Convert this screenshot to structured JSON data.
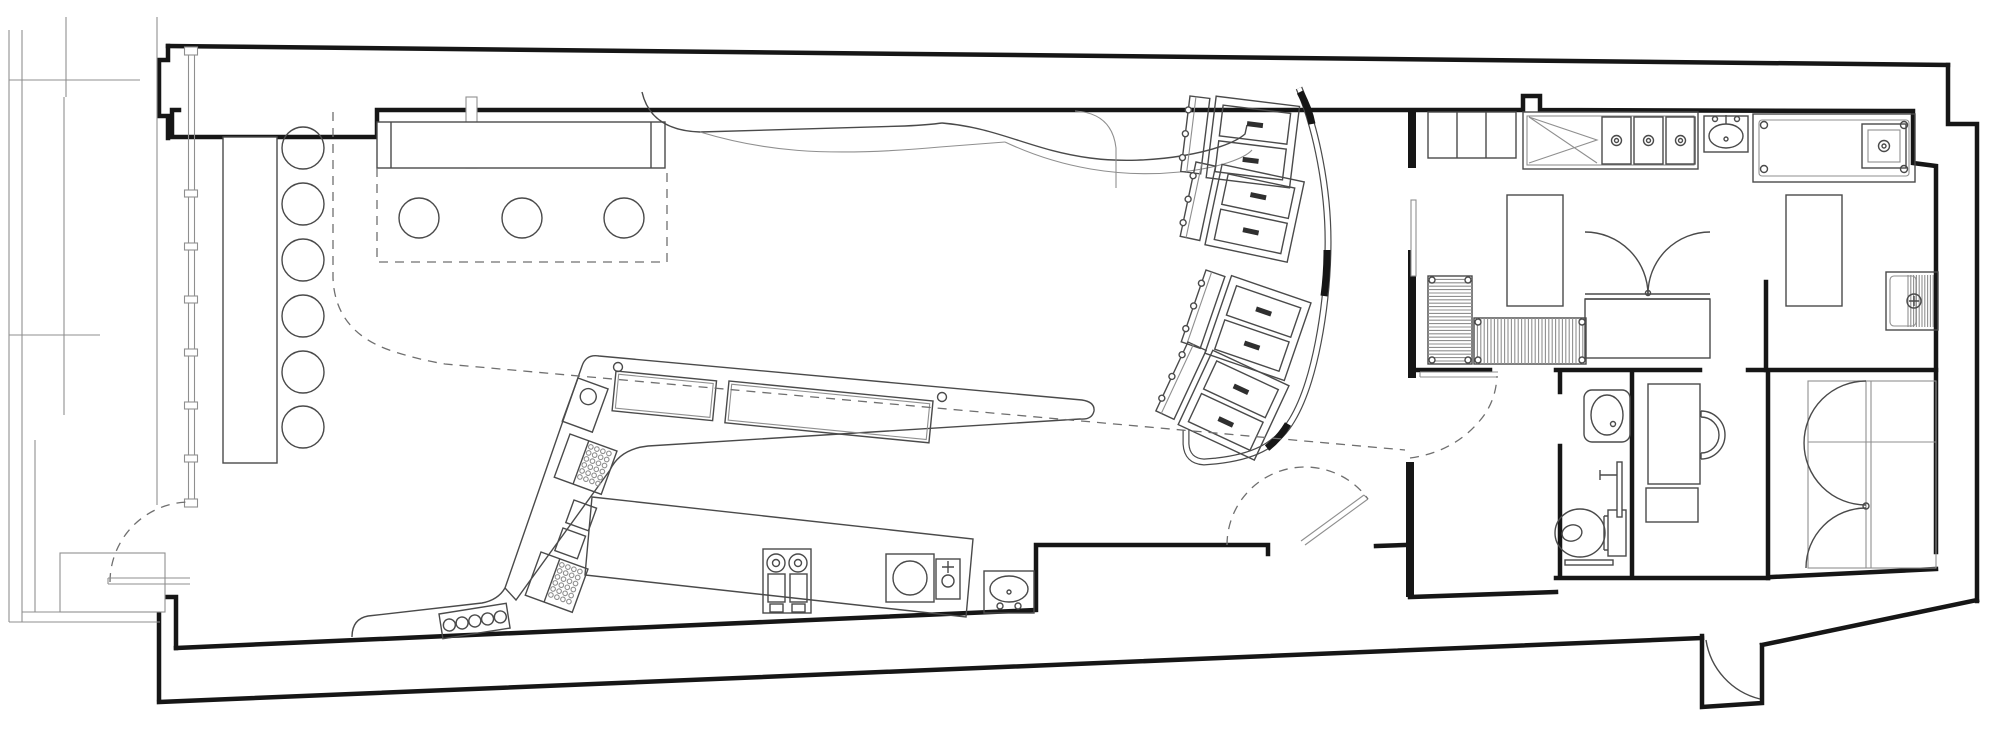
{
  "meta": {
    "title": "Long narrow cafe / restaurant architectural floor plan, black line work on white",
    "drawing_type": "architectural-floor-plan",
    "visible_text": []
  },
  "canvas": {
    "width": 2000,
    "height": 737,
    "background": "#ffffff"
  },
  "colors": {
    "wall": "#161616",
    "fixture": "#4a4a4a",
    "thin": "#8f8f8f",
    "dashline": "#6f6f6f",
    "dark_fill": "#2f2f2f"
  },
  "storefront": {
    "mullion_tick_ys": [
      190,
      243,
      296,
      349,
      402,
      455
    ],
    "mullion_cap_ys": [
      47,
      499
    ]
  },
  "seating": {
    "banquette_stools": {
      "cx": 303,
      "r": 21,
      "ys": [
        148,
        204,
        260,
        316,
        372,
        427
      ]
    },
    "window_tables": {
      "r": 20,
      "cy": 218,
      "xs": [
        419,
        522,
        624
      ]
    },
    "booths": {
      "count": 4,
      "units": [
        {
          "x": 1190,
          "y": 96,
          "rot": 7
        },
        {
          "x": 1196,
          "y": 162,
          "rot": 12
        },
        {
          "x": 1206,
          "y": 270,
          "rot": 19
        },
        {
          "x": 1188,
          "y": 342,
          "rot": 25
        }
      ],
      "unit": {
        "bench": {
          "w": 20,
          "h": 76
        },
        "knob_ys": [
          14,
          38,
          62
        ],
        "table": {
          "x": 26,
          "y": -3,
          "w": 84,
          "h": 82
        },
        "panels": [
          {
            "x": 34,
            "y": 5,
            "w": 68,
            "h": 31
          },
          {
            "x": 34,
            "y": 41,
            "w": 68,
            "h": 31
          }
        ],
        "pill": {
          "w": 16,
          "h": 5
        }
      }
    }
  },
  "bar": {
    "glass_rack": {
      "x": 439,
      "y": 614,
      "rot": -9,
      "w": 68,
      "h": 25,
      "circles": 5,
      "r": 6,
      "pitch": 12.9
    },
    "cup_racks": [
      {
        "x": 570,
        "y": 434,
        "rot": 20
      },
      {
        "x": 541,
        "y": 552,
        "rot": 20
      }
    ],
    "cup_rack_shape": {
      "w": 50,
      "h": 46,
      "split_x": 20,
      "dot_rows": 6,
      "dot_cols": 4,
      "dot_pitch": 6.4,
      "dot_r": 2.3,
      "dot_x0": 24,
      "dot_y0": 5
    },
    "leg_equipment_squares": [
      {
        "x": 574,
        "y": 500,
        "rot": 20,
        "w": 24,
        "h": 24
      },
      {
        "x": 563,
        "y": 528,
        "rot": 20,
        "w": 24,
        "h": 24
      }
    ],
    "brewer": {
      "x": 578,
      "y": 378,
      "rot": 20,
      "w": 32,
      "h": 46,
      "circle_r": 8
    }
  },
  "kitchen": {
    "shelf_divider_xs": [
      1457,
      1486
    ],
    "triple_sink": {
      "cells_x": [
        1602,
        1634,
        1666
      ],
      "cell_y": 117,
      "cell_w": 29,
      "cell_h": 47,
      "drain_r": 5
    },
    "wire_racks": [
      {
        "x": 1428,
        "y": 276,
        "w": 44,
        "h": 88,
        "dir": "h",
        "pitch": 3.4
      },
      {
        "x": 1474,
        "y": 318,
        "w": 112,
        "h": 46,
        "dir": "v",
        "pitch": 3.4
      }
    ],
    "mop_sink_hatch": {
      "x": 1908,
      "y": 275,
      "w": 26,
      "h": 52,
      "pitch": 2.8
    },
    "prep_table_bolts": [
      [
        1764,
        125
      ],
      [
        1904,
        125
      ],
      [
        1764,
        169
      ],
      [
        1904,
        169
      ]
    ]
  }
}
